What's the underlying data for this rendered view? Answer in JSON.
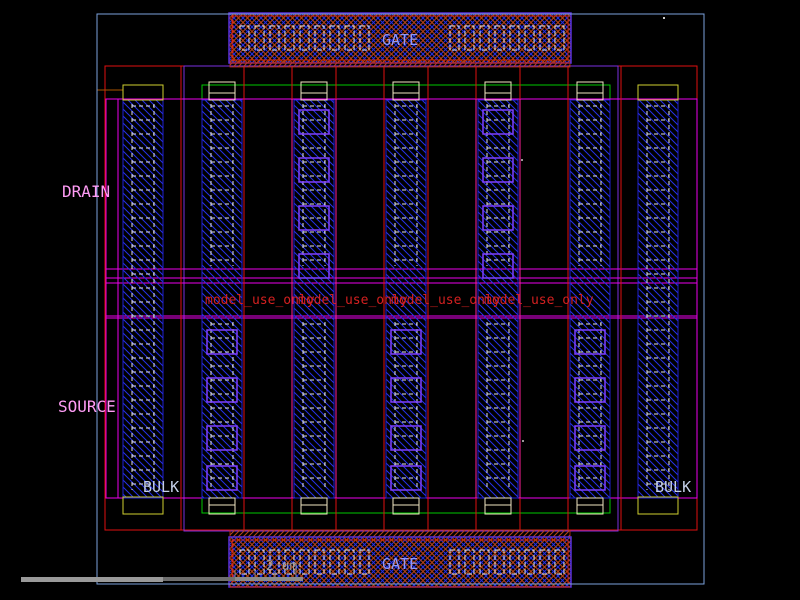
{
  "canvas": {
    "width": 800,
    "height": 600,
    "background": "#000000"
  },
  "labels": {
    "gate_top": "GATE",
    "gate_bottom": "GATE",
    "drain": "DRAIN",
    "source": "SOURCE",
    "bulk_left": "BULK",
    "bulk_right": "BULK",
    "watermark": "model_use_only",
    "watermark_count": 4,
    "scale_text": "2 um"
  },
  "colors": {
    "background": "#000000",
    "boundary_blue": "#7ba2dc",
    "red_outline": "#e01010",
    "poly_hatch_red": "#b84418",
    "magenta": "#ee00ee",
    "bracket_pink": "#ff1f99",
    "metal_blue": "#2530e8",
    "column_stroke": "#2020d0",
    "green": "#00c800",
    "yellow": "#cfcf30",
    "cream": "#efe6c2",
    "gate_purple": "#5a30d8",
    "via_purple": "#8040ff",
    "contact_white": "#e8e8e8",
    "watermark_red": "#d42020",
    "label_pink": "#ff9cf5",
    "label_pale": "#c4cfe8",
    "label_gate": "#9098f8",
    "scale_gray": "#9f9f9f",
    "scrollbar_thumb": "#9a9a9a",
    "scrollbar_dim": "#6f6f6f"
  }
}
